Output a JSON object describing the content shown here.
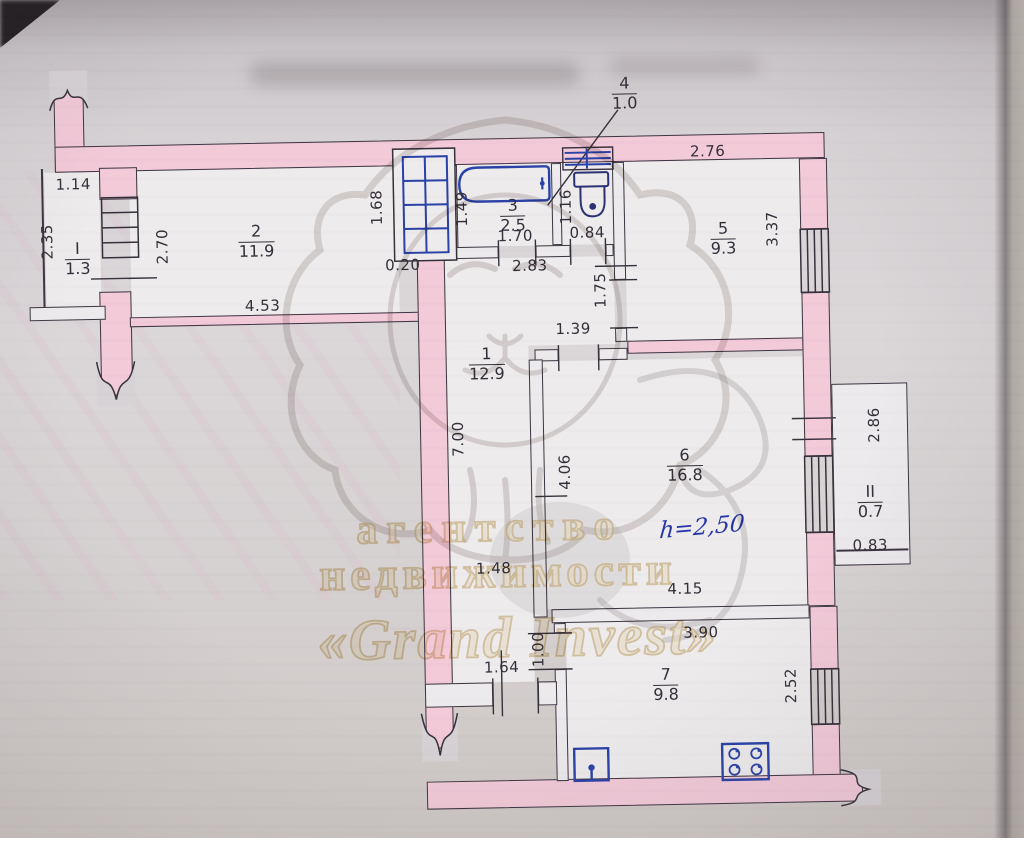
{
  "plan": {
    "rooms": {
      "balcony1": {
        "num": "I",
        "area": "1.3"
      },
      "room2": {
        "num": "2",
        "area": "11.9"
      },
      "bath": {
        "num": "3",
        "area": "2.5"
      },
      "vent": {
        "num": "4",
        "area": "1.0"
      },
      "room5": {
        "num": "5",
        "area": "9.3"
      },
      "hall": {
        "num": "1",
        "area": "12.9"
      },
      "room6": {
        "num": "6",
        "area": "16.8"
      },
      "kitchen": {
        "num": "7",
        "area": "9.8"
      },
      "balcony2": {
        "num": "II",
        "area": "0.7"
      }
    },
    "dims": {
      "d114": "1.14",
      "d235": "2.35",
      "d270": "2.70",
      "d453": "4.53",
      "d168": "1.68",
      "d020": "0.20",
      "d149": "1.49",
      "d170": "1.70",
      "d283": "2.83",
      "d116": "1.16",
      "d084": "0.84",
      "d276": "2.76",
      "d337": "3.37",
      "d175": "1.75",
      "d139": "1.39",
      "d700": "7.00",
      "d406": "4.06",
      "d415": "4.15",
      "d286": "2.86",
      "d083": "0.83",
      "d148": "1.48",
      "d100": "1.00",
      "d164": "1.64",
      "d390": "3.90",
      "d252": "2.52"
    },
    "note_height": "h=2,50"
  },
  "watermark": {
    "line1": "агентство",
    "line2": "недвижимости",
    "line3": "«Grand Invest»"
  },
  "colors": {
    "wall_pink": "#f2c9d8",
    "ink": "#332d38",
    "pen_blue": "#2740a6",
    "watermark_gold": "#c9a96a"
  }
}
